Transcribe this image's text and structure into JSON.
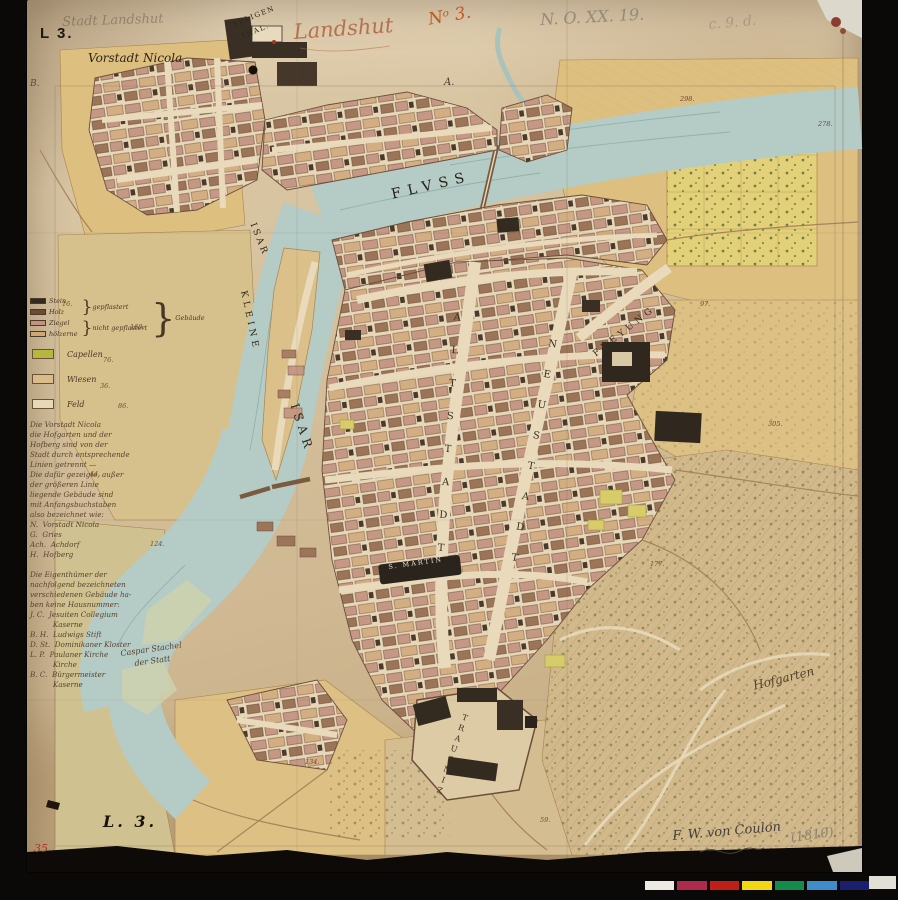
{
  "sheet": {
    "label_top": "L 3.",
    "label_bottom": "L. 3.",
    "red_number": "35"
  },
  "handwriting": {
    "faded_title": "Stadt Landshut",
    "title": "Landshut",
    "number_red": "Nᵒ 3.",
    "archive": "N. O. XX. 19.",
    "archive2": "c. 9. d.",
    "signature": "F. W. von Coulon",
    "year": "(1810)"
  },
  "places": {
    "vorstadt": "Vorstadt Nicola",
    "seligenthal_1": "SELIGEN",
    "seligenthal_2": "THAL.",
    "fluss": "FLVSS",
    "isar_upper": "ISAR",
    "kleine": "KLEINE",
    "isar_main": "ISAR",
    "altstadt": "ALTSTADT",
    "neustadt": "NEUSTADT",
    "freyung": "FREYUNG",
    "st_martin": "S. MARTIN",
    "trausnitz": "TRAUSNIZ",
    "hofgarten": "Hofgarten",
    "caspar_1": "Caspar Stachel",
    "caspar_2": "der Statt",
    "letter_a": "A.",
    "letter_b": "B."
  },
  "legend": {
    "building_rows": [
      {
        "color": "#332a1f",
        "label": "Stein"
      },
      {
        "color": "#6e4a33",
        "label": "Holz"
      },
      {
        "color": "#c4917e",
        "label": "Ziegel"
      },
      {
        "color": "#cfa875",
        "label": "hölzerne"
      }
    ],
    "bracket_top": "gepflastert",
    "bracket_bottom": "nicht gepflastert",
    "bracket_right": "Gebäude",
    "extra_rows": [
      {
        "color": "#b5b83e",
        "label": "Capellen"
      },
      {
        "color": "#d8bd8b",
        "label": "Wiesen"
      },
      {
        "color": "#e6d9b8",
        "label": "Feld"
      }
    ]
  },
  "notes": {
    "lines": [
      "Die Vorstadt Nicola",
      "die Hofgarten und der",
      "Hofberg sind von der",
      "Stadt durch entsprechende",
      "Linien getrennt —",
      "Die dafür gezeigte, außer",
      "der größeren Linie",
      "liegende Gebäude sind",
      "mit Anfangsbuchstaben",
      "also bezeichnet wie:",
      "N.  Vorstadt Nicola",
      "G.  Gries",
      "Ach.  Achdorf",
      "H.  Hofberg",
      "",
      "Die Eigenthümer der",
      "nachfolgend bezeichneten",
      "verschiedenen Gebäude ha-",
      "ben keine Hausnummer:",
      "J. C.  Jesuiten Collegium",
      "          Kaserne",
      "B. H.  Ludwigs Stift",
      "D. St.  Dominikaner Kloster",
      "L. P.  Paulaner Kirche",
      "          Kirche",
      "B. C.  Bürgermeister",
      "          Kaserne"
    ]
  },
  "parcel_numbers": [
    {
      "n": "160.",
      "x": 130,
      "y": 323
    },
    {
      "n": "76.",
      "x": 103,
      "y": 356
    },
    {
      "n": "36.",
      "x": 100,
      "y": 382
    },
    {
      "n": "86.",
      "x": 118,
      "y": 402
    },
    {
      "n": "44.",
      "x": 90,
      "y": 470
    },
    {
      "n": "124.",
      "x": 150,
      "y": 540
    },
    {
      "n": "16.",
      "x": 62,
      "y": 300
    },
    {
      "n": "97.",
      "x": 700,
      "y": 300
    },
    {
      "n": "305.",
      "x": 768,
      "y": 420
    },
    {
      "n": "177.",
      "x": 650,
      "y": 560
    },
    {
      "n": "134.",
      "x": 305,
      "y": 758
    },
    {
      "n": "59.",
      "x": 540,
      "y": 816
    },
    {
      "n": "278.",
      "x": 818,
      "y": 120
    },
    {
      "n": "298.",
      "x": 680,
      "y": 95
    }
  ],
  "color_bar": {
    "background": "#050505",
    "segments": [
      "#eceae3",
      "#b02a4e",
      "#c01f17",
      "#f2d714",
      "#148b4d",
      "#3f8ccb",
      "#1a2070"
    ]
  },
  "palette": {
    "paper": "#d4bd98",
    "river": "#b5cbc5",
    "field": "#ddbf80",
    "ink": "#5f4630"
  }
}
